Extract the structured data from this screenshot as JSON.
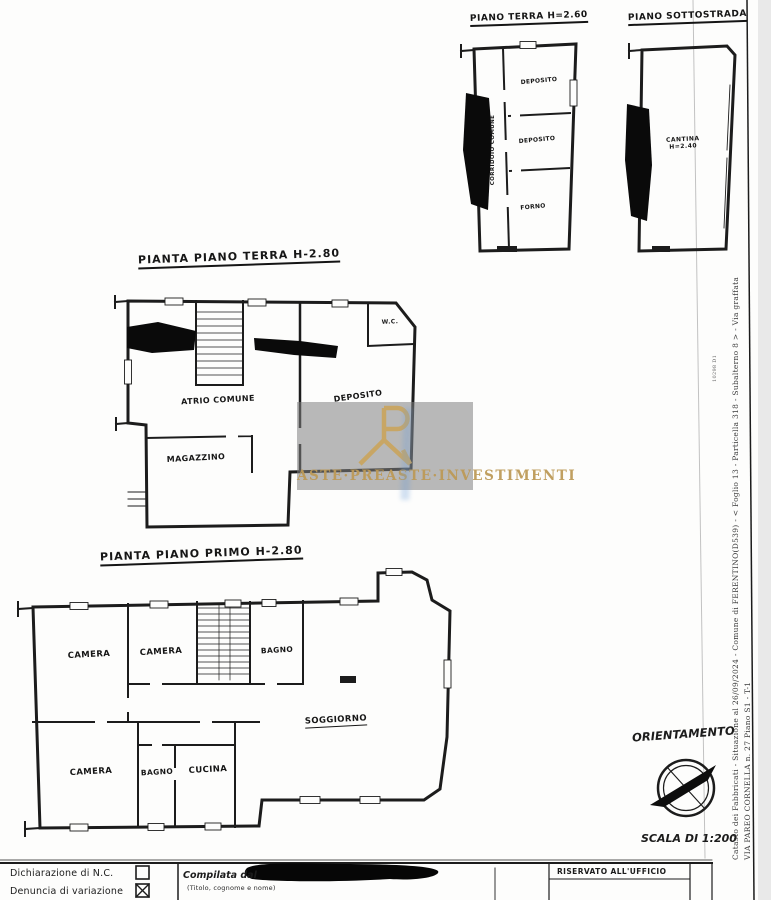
{
  "titles": {
    "plan_small_terra": "PIANO TERRA H=2.60",
    "plan_sottostrada": "PIANO SOTTOSTRADA",
    "plan_terra": "PIANTA PIANO TERRA H-2.80",
    "plan_primo": "PIANTA PIANO PRIMO H-2.80"
  },
  "rooms": {
    "small_terra": {
      "corridor": "CORRIDOIO COMUNE",
      "dep1": "DEPOSITO",
      "dep2": "DEPOSITO",
      "forno": "FORNO"
    },
    "sottostrada": {
      "cantina": "CANTINA",
      "cantina_h": "H=2.40"
    },
    "terra": {
      "atrio": "ATRIO COMUNE",
      "magazzino": "MAGAZZINO",
      "deposito": "DEPOSITO",
      "wc": "W.C."
    },
    "primo": {
      "camera1": "CAMERA",
      "camera2": "CAMERA",
      "bagno1": "BAGNO",
      "soggiorno": "SOGGIORNO",
      "camera3": "CAMERA",
      "bagno2": "BAGNO",
      "cucina": "CUCINA"
    }
  },
  "margin": {
    "cadastre_line": "Catasto dei Fabbricati - Situazione al 26/09/2024 - Comune di FERENTINO(D539) - < Foglio 13 - Particella 318 - Subalterno 8 > - Via graffata",
    "address_line": "VIA PAREO CORNELLA n. 27 Piano S1 - T-1",
    "doc_code": "10298 D1"
  },
  "orientation_label": "ORIENTAMENTO",
  "scale_label": "SCALA DI 1:200",
  "footer": {
    "row1": "Dichiarazione di N.C.",
    "row2": "Denuncia di variazione",
    "box1_checked": false,
    "box2_checked": true,
    "compiled": "Compilata dal",
    "compiled_hint": "(Titolo, cognome e nome)",
    "office": "RISERVATO ALL'UFFICIO"
  },
  "watermark": {
    "brand": "ASTE·PREASTE·INVESTIMENTI",
    "logo_icon": "R-monogram"
  },
  "colors": {
    "ink": "#1c1c1c",
    "gold": "#c9a661",
    "band_gray": "rgba(128,128,128,0.55)",
    "scan_edge": "#e9e9e9"
  }
}
